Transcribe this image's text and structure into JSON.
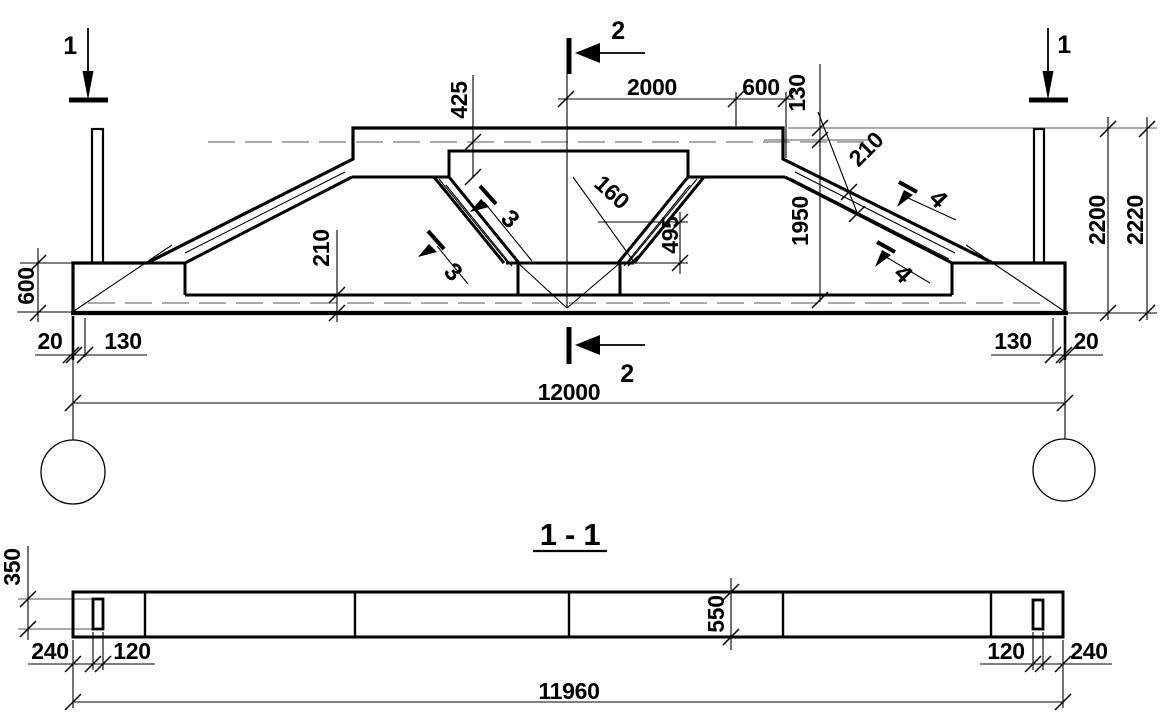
{
  "elevation": {
    "markers": {
      "m1": "1",
      "m2": "2",
      "m3": "3",
      "m4": "4"
    },
    "dims": {
      "d425": "425",
      "d2000": "2000",
      "d600_top": "600",
      "d130_top": "130",
      "d210_haunch": "210",
      "d1950": "1950",
      "d2200": "2200",
      "d2220": "2220",
      "d160": "160",
      "d495": "495",
      "d210_chord": "210",
      "d600_left": "600",
      "d20_left": "20",
      "d130_left": "130",
      "d130_right": "130",
      "d20_right": "20",
      "d12000": "12000"
    }
  },
  "section_view": {
    "title": "1 - 1",
    "dims": {
      "d350": "350",
      "d240_left": "240",
      "d120_left": "120",
      "d550": "550",
      "d120_right": "120",
      "d240_right": "240",
      "d11960": "11960"
    }
  },
  "colors": {
    "line_color": "#000000",
    "aux_line_color": "#8f8f8f",
    "background": "#ffffff"
  }
}
